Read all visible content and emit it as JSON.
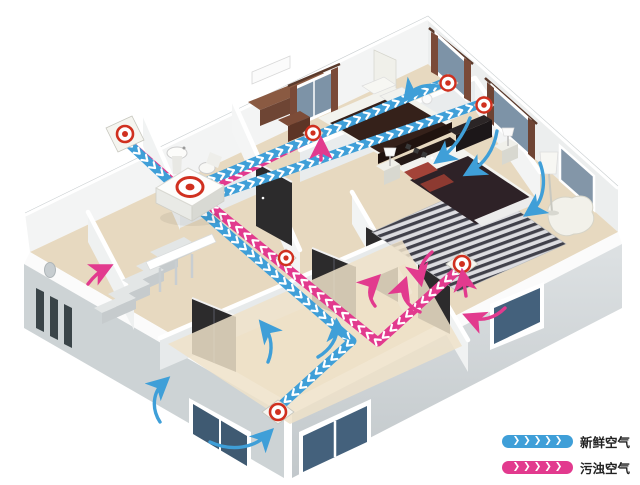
{
  "legend": {
    "items": [
      {
        "name": "fresh-air",
        "label": "新鲜空气",
        "chevrons": "❯❯❯❯❯",
        "color": "#3f9fd8"
      },
      {
        "name": "stale-air",
        "label": "污浊空气",
        "chevrons": "❯❯❯❯❯",
        "color": "#e23a8e"
      }
    ]
  },
  "colors": {
    "fresh": "#3f9fd8",
    "stale": "#e23a8e",
    "vent_red": "#d0301f",
    "floor": "#e7d9c0",
    "wall": "#f3f4f4",
    "glass": "#7d93a7",
    "text": "#222222"
  },
  "diagram": {
    "type": "isometric-cutaway-floorplan",
    "subject": "home-fresh-air-ventilation-system",
    "components": [
      "outdoor-wall-vent",
      "ventilation-unit",
      "supply-air-vent",
      "extract-air-vent",
      "fresh-air-duct",
      "stale-air-duct",
      "airflow-arrows"
    ],
    "rooms": [
      "bedroom",
      "master-bedroom",
      "bathroom",
      "hallway",
      "living-room",
      "staircase"
    ]
  }
}
